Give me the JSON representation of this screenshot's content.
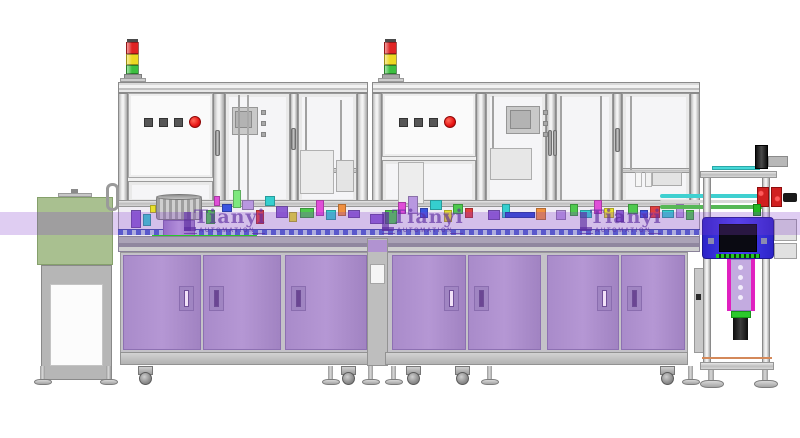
{
  "title": "Automated assembly line – CAD side view render",
  "watermark": {
    "brand": "Tianyi",
    "subtitle": "AUTOMATION",
    "band_color": "rgba(130,60,205,0.26)",
    "logo_color": "rgba(92,44,160,0.65)",
    "logo_positions_x": [
      184,
      382,
      580
    ]
  },
  "signal_towers": {
    "positions_x": [
      126,
      384
    ],
    "segment_colors": [
      "#e02424",
      "#ecd822",
      "#3cc040"
    ]
  },
  "control_panels": [
    {
      "x": 144,
      "y": 116,
      "squares": 3,
      "square_color": "#565656",
      "stop_color": "#e81414"
    },
    {
      "x": 399,
      "y": 116,
      "squares": 3,
      "square_color": "#565656",
      "stop_color": "#e81414"
    }
  ],
  "cabinets": {
    "door_color": "#ae90cf",
    "handle_light": "#f2e2f8",
    "handle_dark": "#6b4693",
    "doors": [
      {
        "x": 123,
        "w": 78,
        "handle": "right",
        "slot": "light"
      },
      {
        "x": 203,
        "w": 78,
        "handle": "left",
        "slot": "dark"
      },
      {
        "x": 285,
        "w": 82,
        "handle": "left",
        "slot": "dark"
      },
      {
        "x": 392,
        "w": 74,
        "handle": "right",
        "slot": "light"
      },
      {
        "x": 468,
        "w": 73,
        "handle": "left",
        "slot": "dark"
      },
      {
        "x": 547,
        "w": 72,
        "handle": "right",
        "slot": "light"
      },
      {
        "x": 621,
        "w": 64,
        "handle": "left",
        "slot": "dark"
      }
    ]
  },
  "feet": [
    {
      "x": 34,
      "type": "foot"
    },
    {
      "x": 100,
      "type": "foot"
    },
    {
      "x": 138,
      "type": "caster"
    },
    {
      "x": 322,
      "type": "foot"
    },
    {
      "x": 341,
      "type": "caster"
    },
    {
      "x": 362,
      "type": "foot"
    },
    {
      "x": 385,
      "type": "foot"
    },
    {
      "x": 406,
      "type": "caster"
    },
    {
      "x": 455,
      "type": "caster"
    },
    {
      "x": 481,
      "type": "foot"
    },
    {
      "x": 660,
      "type": "caster"
    },
    {
      "x": 682,
      "type": "foot"
    },
    {
      "x": 700,
      "type": "bigfoot"
    },
    {
      "x": 754,
      "type": "bigfoot"
    }
  ],
  "machinery_blocks": [
    [
      238,
      95,
      2,
      105,
      "#d6d6d6"
    ],
    [
      247,
      95,
      2,
      105,
      "#e2e2e2"
    ],
    [
      305,
      97,
      2,
      73,
      "#d6d6d6"
    ],
    [
      340,
      100,
      2,
      70,
      "#dcdcdc"
    ],
    [
      492,
      96,
      2,
      74,
      "#d8d8d8"
    ],
    [
      560,
      96,
      2,
      104,
      "#dadada"
    ],
    [
      600,
      96,
      2,
      104,
      "#d6d6d6"
    ],
    [
      630,
      96,
      2,
      74,
      "#dcdcdc"
    ],
    [
      300,
      150,
      34,
      44,
      "#ececec"
    ],
    [
      336,
      160,
      18,
      32,
      "#e4e4e4"
    ],
    [
      398,
      162,
      26,
      42,
      "#ededed"
    ],
    [
      490,
      148,
      42,
      32,
      "#e7e7e7"
    ],
    [
      652,
      172,
      30,
      14,
      "#e3e3e3"
    ],
    [
      635,
      172,
      7,
      15,
      "#f6f6f6"
    ],
    [
      645,
      172,
      7,
      15,
      "#f2f2f2"
    ],
    [
      131,
      210,
      10,
      18,
      "#8d5fd3"
    ],
    [
      143,
      214,
      8,
      12,
      "#35cfcf"
    ],
    [
      150,
      205,
      6,
      8,
      "#e8e02c"
    ],
    [
      206,
      210,
      9,
      14,
      "#4ec94e"
    ],
    [
      214,
      196,
      6,
      10,
      "#e04ed8"
    ],
    [
      222,
      204,
      10,
      8,
      "#3b55e0"
    ],
    [
      233,
      190,
      8,
      18,
      "#7de87d"
    ],
    [
      242,
      200,
      12,
      10,
      "#b897e0"
    ],
    [
      256,
      210,
      8,
      14,
      "#e04040"
    ],
    [
      265,
      196,
      10,
      10,
      "#35cfcf"
    ],
    [
      276,
      206,
      12,
      12,
      "#8d5fd3"
    ],
    [
      289,
      212,
      8,
      10,
      "#e8e02c"
    ],
    [
      300,
      208,
      14,
      10,
      "#4ec94e"
    ],
    [
      316,
      200,
      8,
      16,
      "#e04ed8"
    ],
    [
      326,
      210,
      10,
      10,
      "#35cfcf"
    ],
    [
      338,
      204,
      8,
      12,
      "#f09040"
    ],
    [
      348,
      210,
      12,
      8,
      "#8d5fd3"
    ],
    [
      370,
      214,
      14,
      10,
      "#8d5fd3"
    ],
    [
      385,
      210,
      12,
      14,
      "#4ec94e"
    ],
    [
      398,
      202,
      8,
      12,
      "#e04ed8"
    ],
    [
      408,
      196,
      10,
      18,
      "#b897e0"
    ],
    [
      420,
      208,
      8,
      10,
      "#3b55e0"
    ],
    [
      430,
      200,
      12,
      10,
      "#35cfcf"
    ],
    [
      444,
      210,
      8,
      12,
      "#e8e02c"
    ],
    [
      453,
      204,
      10,
      10,
      "#4ec94e"
    ],
    [
      465,
      208,
      8,
      10,
      "#e04040"
    ],
    [
      488,
      210,
      12,
      10,
      "#8d5fd3"
    ],
    [
      502,
      204,
      8,
      14,
      "#35cfcf"
    ],
    [
      505,
      212,
      30,
      6,
      "#2848d0"
    ],
    [
      536,
      208,
      10,
      12,
      "#f09040"
    ],
    [
      556,
      210,
      10,
      10,
      "#b897e0"
    ],
    [
      570,
      204,
      8,
      12,
      "#4ec94e"
    ],
    [
      580,
      210,
      12,
      8,
      "#35cfcf"
    ],
    [
      594,
      200,
      8,
      14,
      "#e04ed8"
    ],
    [
      604,
      208,
      10,
      10,
      "#e8e02c"
    ],
    [
      616,
      210,
      8,
      12,
      "#8d5fd3"
    ],
    [
      628,
      204,
      10,
      10,
      "#4ec94e"
    ],
    [
      640,
      210,
      8,
      8,
      "#3b55e0"
    ],
    [
      650,
      206,
      10,
      12,
      "#e04040"
    ],
    [
      662,
      210,
      12,
      8,
      "#35cfcf"
    ],
    [
      676,
      204,
      8,
      14,
      "#b897e0"
    ],
    [
      686,
      210,
      8,
      10,
      "#4ec94e"
    ]
  ],
  "right_station": {
    "housing_color": "#3c34e8",
    "tool_color": "#c3abe0",
    "tube_colors": [
      "#3fd0d0",
      "#d8d8d8",
      "#57b857"
    ]
  },
  "left_stand": {
    "cover_color": "#a8bf92"
  }
}
